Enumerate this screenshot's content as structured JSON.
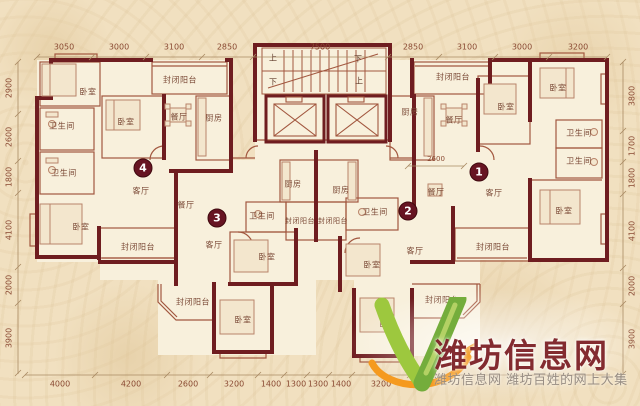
{
  "dims": {
    "top": [
      "3050",
      "3000",
      "3100",
      "2850",
      "7500",
      "2850",
      "3100",
      "3000",
      "3200"
    ],
    "bottom": [
      "4000",
      "4200",
      "2600",
      "3200",
      "1400",
      "1300",
      "1300",
      "1400",
      "3200",
      "2600"
    ],
    "left": [
      "2900",
      "2600",
      "1800",
      "4100",
      "2000",
      "3900"
    ],
    "right": [
      "3800",
      "1700",
      "1800",
      "4100",
      "2000",
      "3900"
    ],
    "internal": [
      "2600"
    ]
  },
  "unit_labels": [
    "1",
    "2",
    "3",
    "4"
  ],
  "stairs": {
    "up": "上",
    "down": "下"
  },
  "rooms": [
    {
      "label": "卧室"
    },
    {
      "label": "卫生间"
    },
    {
      "label": "卫生间"
    },
    {
      "label": "卧室"
    },
    {
      "label": "封闭阳台"
    },
    {
      "label": "餐厅"
    },
    {
      "label": "厨房"
    },
    {
      "label": "客厅"
    },
    {
      "label": "卧室"
    },
    {
      "label": "封闭阳台"
    },
    {
      "label": "餐厅"
    },
    {
      "label": "客厅"
    },
    {
      "label": "厨房"
    },
    {
      "label": "卫生间"
    },
    {
      "label": "封闭阳台"
    },
    {
      "label": "卧室"
    },
    {
      "label": "封闭阳台"
    },
    {
      "label": "卧室"
    },
    {
      "label": "厨房"
    },
    {
      "label": "封闭阳台"
    },
    {
      "label": "卫生间"
    },
    {
      "label": "卧室"
    },
    {
      "label": "客厅"
    },
    {
      "label": "封闭阳台"
    },
    {
      "label": "卧室"
    },
    {
      "label": "封闭阳台"
    },
    {
      "label": "封闭阳台"
    },
    {
      "label": "厨房"
    },
    {
      "label": "餐厅"
    },
    {
      "label": "卧室"
    },
    {
      "label": "卧室"
    },
    {
      "label": "卫生间"
    },
    {
      "label": "卫生间"
    },
    {
      "label": "餐厅"
    },
    {
      "label": "客厅"
    },
    {
      "label": "卧室"
    }
  ],
  "watermark": {
    "title": "潍坊信息网",
    "tagline": "潍坊信息网 潍坊百姓的网上大集",
    "green": "#8fbf3f",
    "orange": "#f59a1f"
  }
}
